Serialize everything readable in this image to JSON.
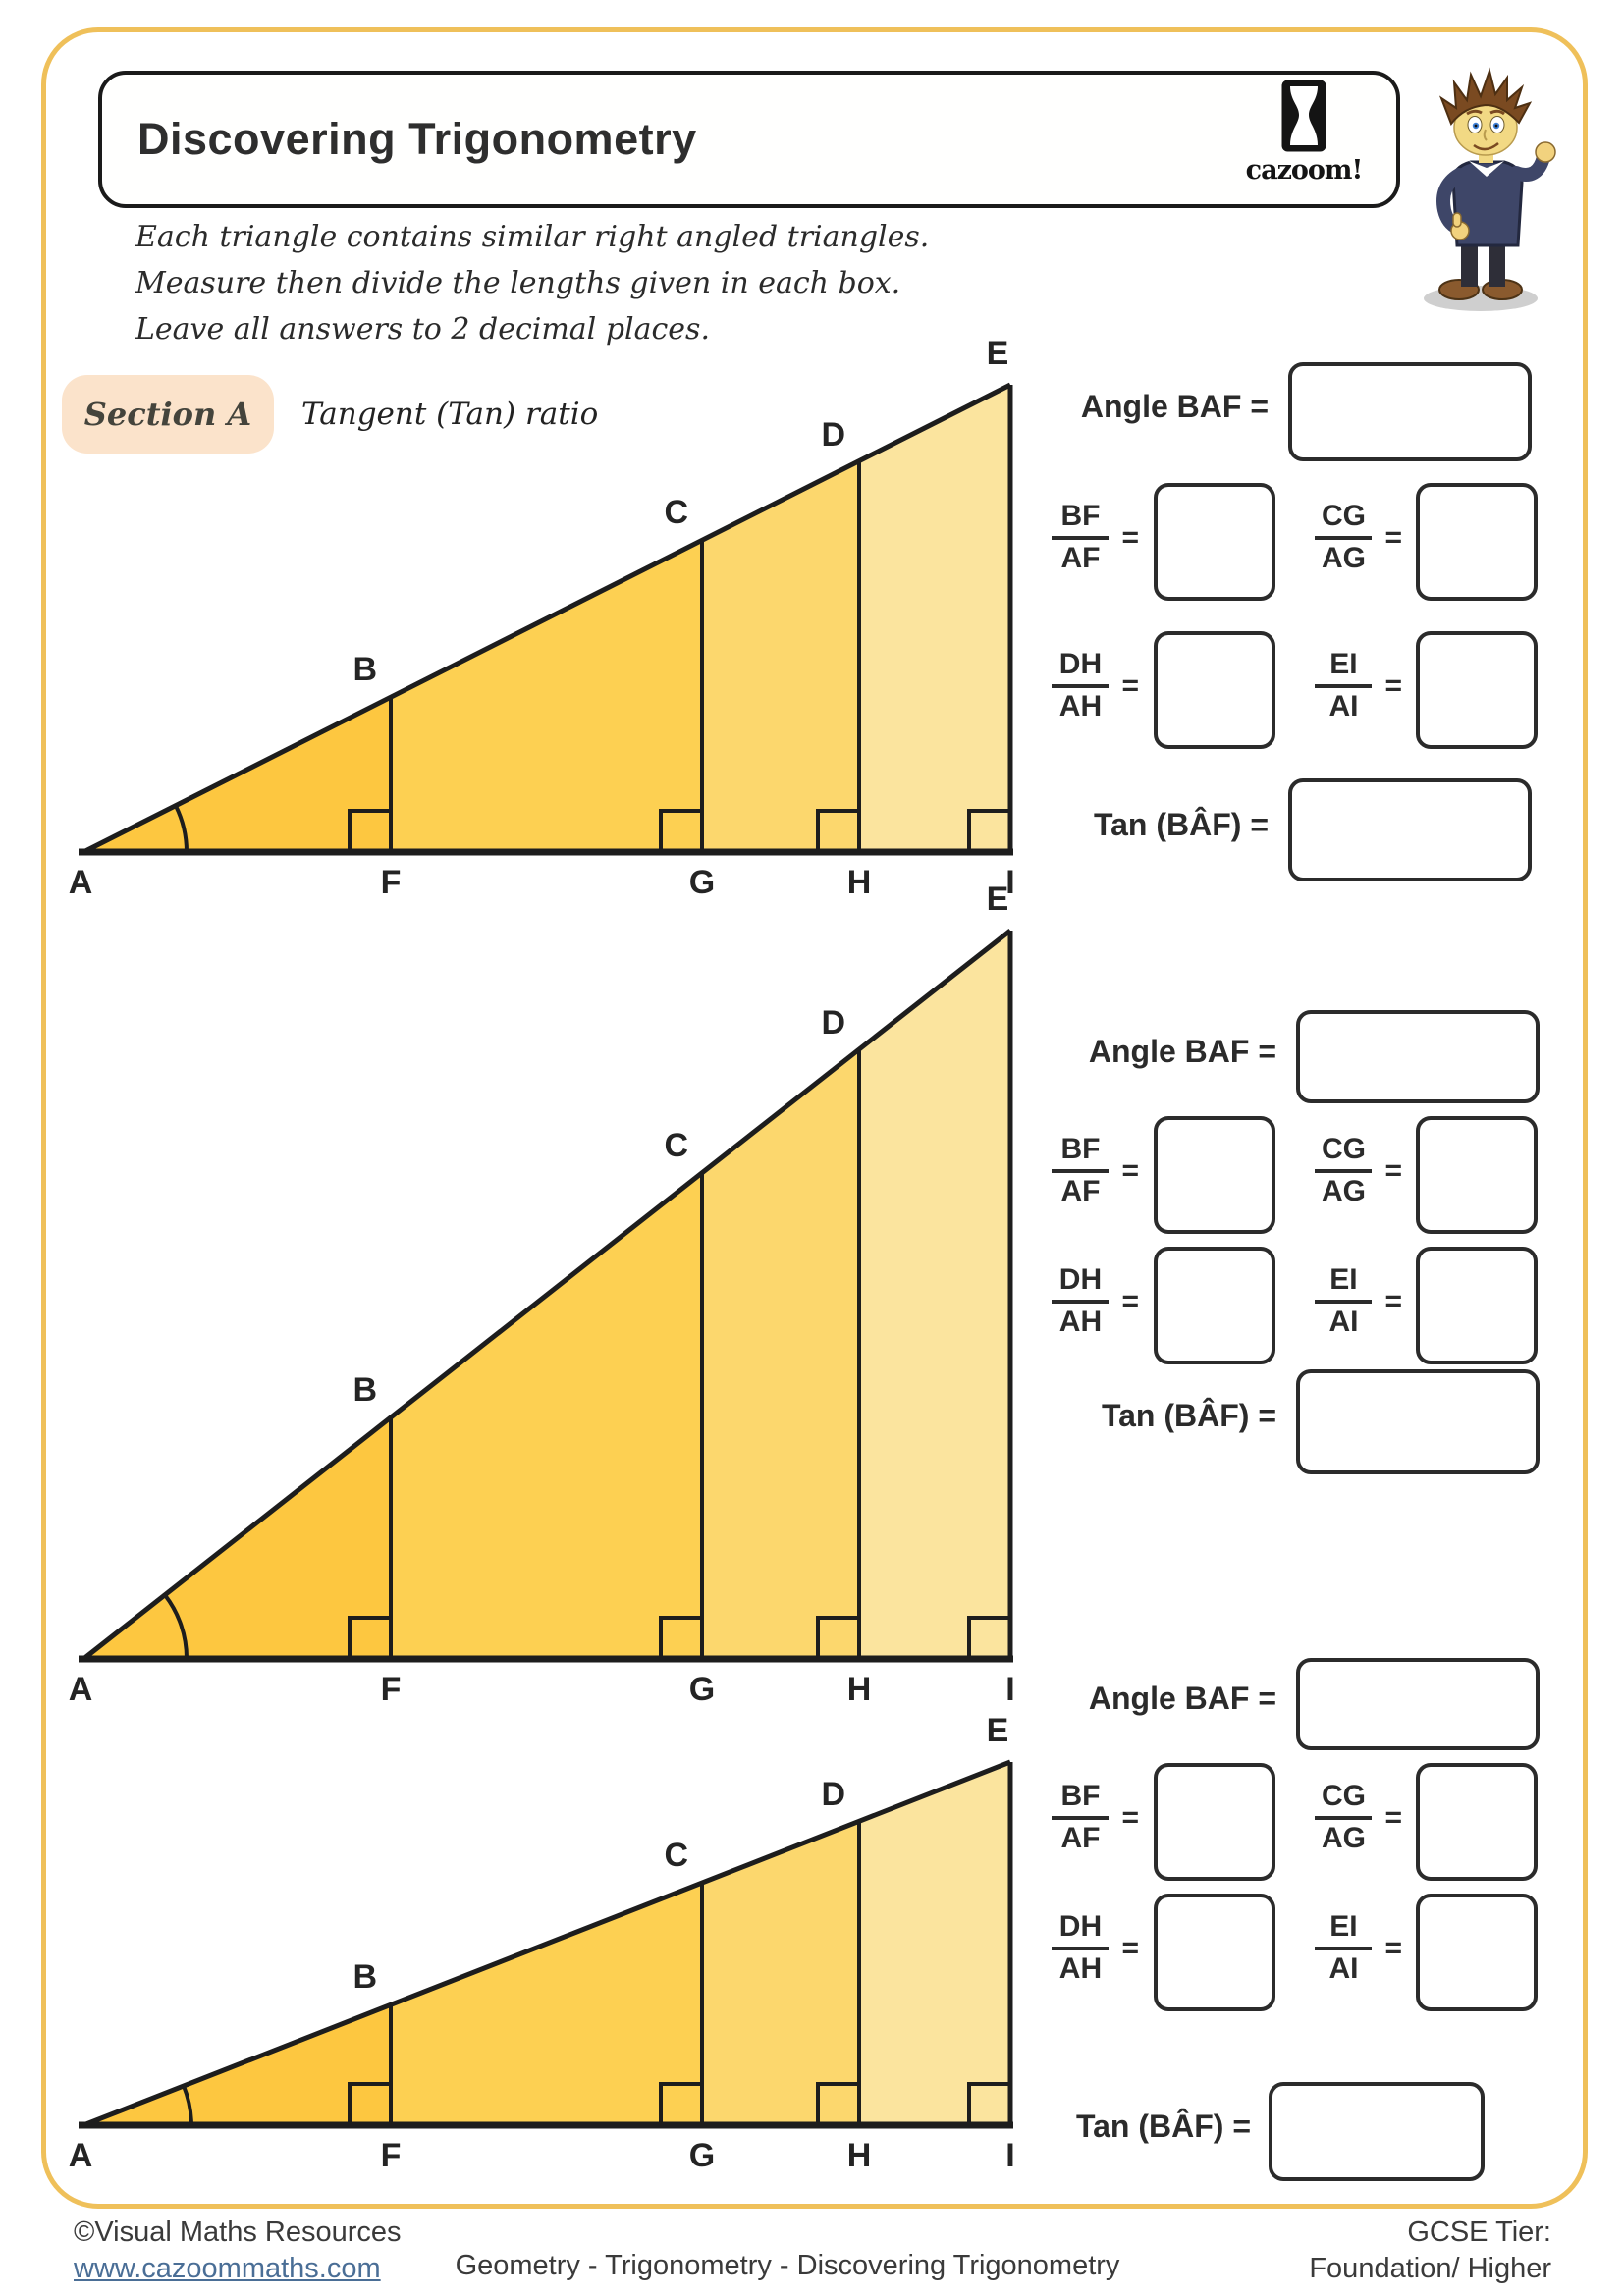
{
  "header": {
    "title": "Discovering Trigonometry",
    "brand": "cazoom!"
  },
  "instructions": [
    "Each triangle contains similar right angled triangles.",
    "Measure then divide the lengths given in each box.",
    "Leave all answers to 2 decimal places."
  ],
  "section": {
    "badge": "Section A",
    "subtitle": "Tangent (Tan) ratio"
  },
  "vertex_labels": {
    "A": "A",
    "B": "B",
    "C": "C",
    "D": "D",
    "E": "E",
    "F": "F",
    "G": "G",
    "H": "H",
    "I": "I"
  },
  "answers": {
    "angle": "Angle BAF =",
    "tan": "Tan (BÂF) =",
    "eq": "=",
    "frac1": {
      "num": "BF",
      "den": "AF"
    },
    "frac2": {
      "num": "CG",
      "den": "AG"
    },
    "frac3": {
      "num": "DH",
      "den": "AH"
    },
    "frac4": {
      "num": "EI",
      "den": "AI"
    }
  },
  "footer": {
    "copyright": "©Visual Maths Resources",
    "url": "www.cazoommaths.com",
    "center": "Geometry - Trigonometry - Discovering Trigonometry",
    "tier_label": "GCSE Tier:",
    "tier_value": "Foundation/ Higher"
  },
  "colors": {
    "frame": "#efc05a",
    "badge_bg": "#fbe3cb",
    "band1": "#fdc740",
    "band2": "#fdd052",
    "band3": "#fcd76d",
    "band4": "#fbe49e",
    "link": "#4a6e96"
  }
}
